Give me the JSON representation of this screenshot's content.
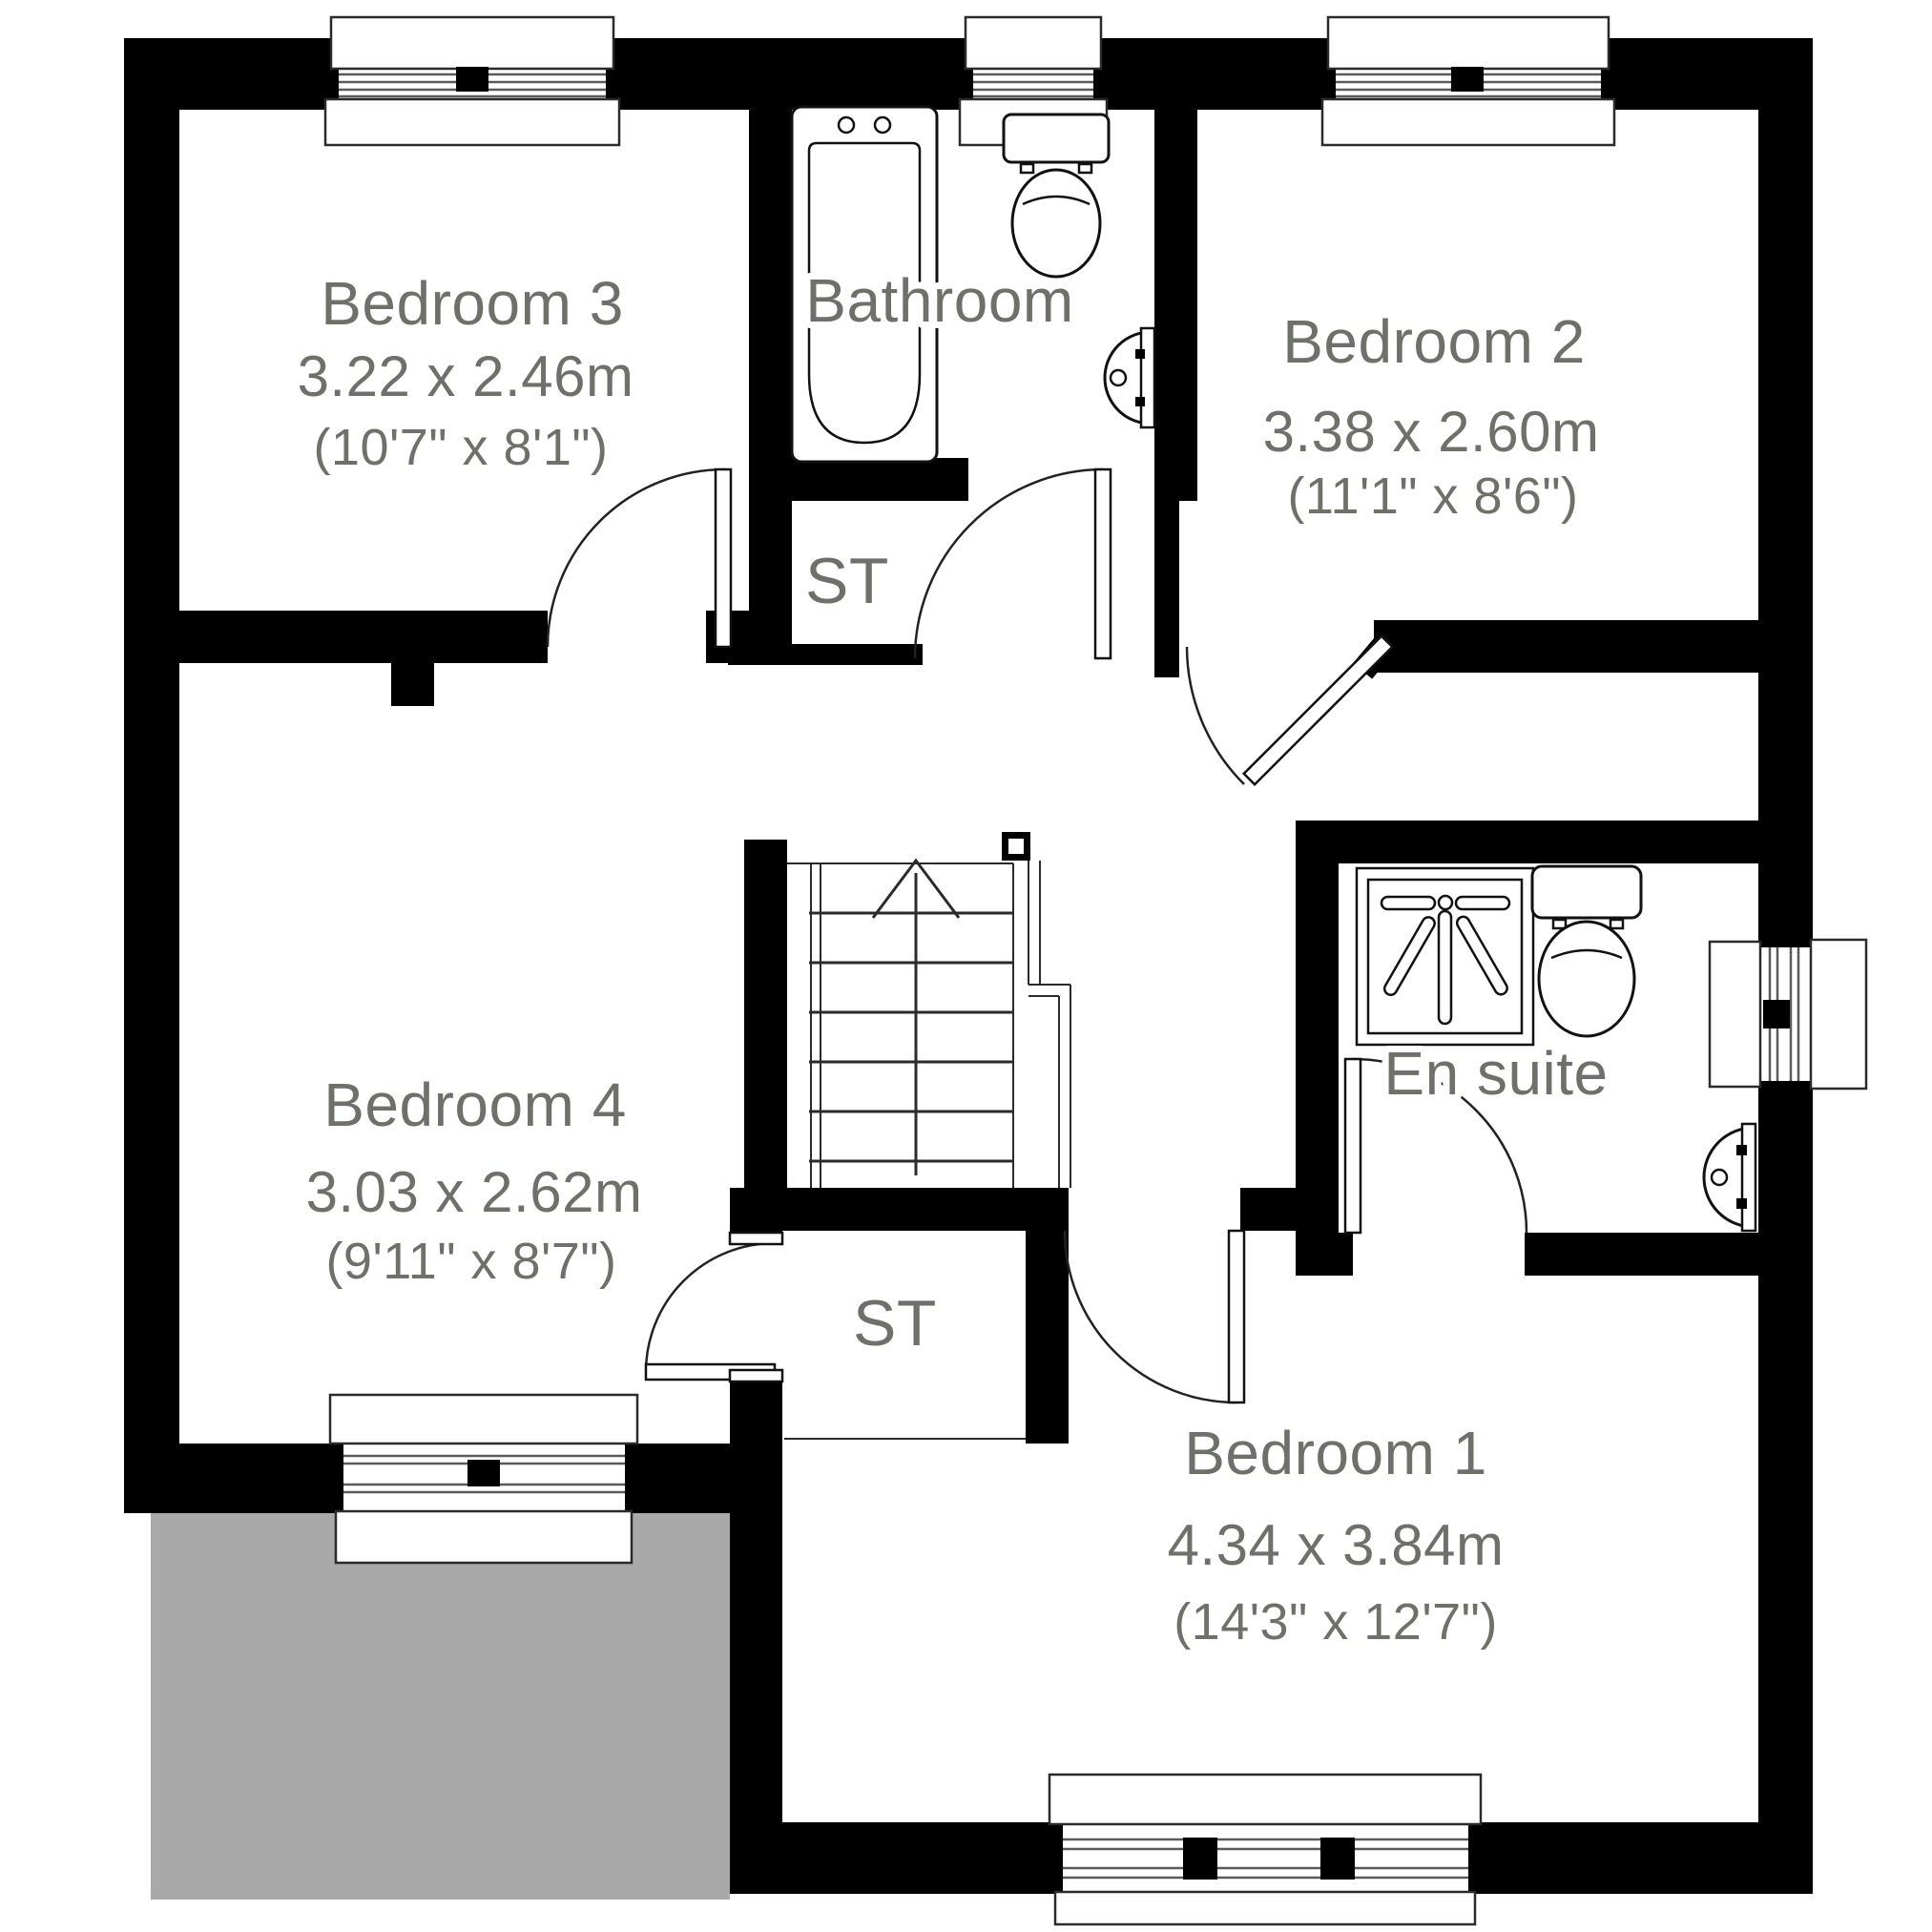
{
  "rooms": {
    "bedroom3": {
      "name": "Bedroom 3",
      "metric": "3.22 x 2.46m",
      "imperial": "(10'7\" x 8'1\")"
    },
    "bathroom": {
      "name": "Bathroom"
    },
    "bedroom2": {
      "name": "Bedroom 2",
      "metric": "3.38 x 2.60m",
      "imperial": "(11'1\" x 8'6\")"
    },
    "storage1": {
      "name": "ST"
    },
    "bedroom4": {
      "name": "Bedroom 4",
      "metric": "3.03 x 2.62m",
      "imperial": "(9'11\" x 8'7\")"
    },
    "storage2": {
      "name": "ST"
    },
    "ensuite": {
      "name": "En suite"
    },
    "bedroom1": {
      "name": "Bedroom 1",
      "metric": "4.34 x 3.84m",
      "imperial": "(14'3\" x 12'7\")"
    }
  },
  "colors": {
    "wall": "#000000",
    "label": "#6e716a",
    "roof": "#a9a9a9",
    "background": "#ffffff"
  }
}
